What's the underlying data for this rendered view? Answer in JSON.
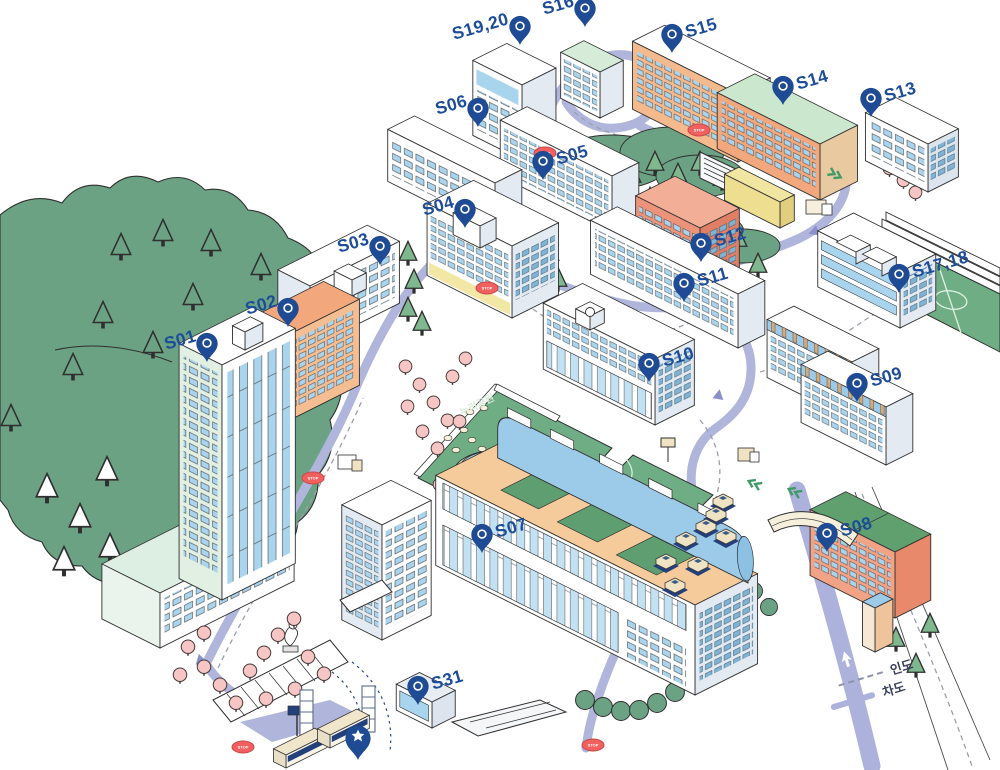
{
  "map": {
    "park_label": "누리공원",
    "stop_sign_label": "STOP",
    "colors": {
      "marker_navy": "#1D4D99",
      "road_lavender": "#B0B5DC",
      "forest_green": "#6CA284",
      "field_green": "#6FAE85",
      "stop_red": "#F15F5F"
    },
    "markers": [
      {
        "id": "s01",
        "label": "S01",
        "x": 207,
        "y": 362,
        "side": "left"
      },
      {
        "id": "s02",
        "label": "S02",
        "x": 288,
        "y": 327,
        "side": "left"
      },
      {
        "id": "s03",
        "label": "S03",
        "x": 380,
        "y": 265,
        "side": "left"
      },
      {
        "id": "s04",
        "label": "S04",
        "x": 465,
        "y": 228,
        "side": "left"
      },
      {
        "id": "s05",
        "label": "S05",
        "x": 543,
        "y": 180,
        "side": "right"
      },
      {
        "id": "s06",
        "label": "S06",
        "x": 478,
        "y": 127,
        "side": "left"
      },
      {
        "id": "s07",
        "label": "S07",
        "x": 482,
        "y": 553,
        "side": "right"
      },
      {
        "id": "s08",
        "label": "S08",
        "x": 827,
        "y": 552,
        "side": "right"
      },
      {
        "id": "s09",
        "label": "S09",
        "x": 857,
        "y": 402,
        "side": "right"
      },
      {
        "id": "s10",
        "label": "S10",
        "x": 649,
        "y": 382,
        "side": "right"
      },
      {
        "id": "s11",
        "label": "S11",
        "x": 684,
        "y": 302,
        "side": "right"
      },
      {
        "id": "s12",
        "label": "S12",
        "x": 701,
        "y": 262,
        "side": "right"
      },
      {
        "id": "s13",
        "label": "S13",
        "x": 871,
        "y": 117,
        "side": "right"
      },
      {
        "id": "s14",
        "label": "S14",
        "x": 783,
        "y": 105,
        "side": "right"
      },
      {
        "id": "s15",
        "label": "S15",
        "x": 672,
        "y": 53,
        "side": "right"
      },
      {
        "id": "s16",
        "label": "S16",
        "x": 585,
        "y": 27,
        "side": "left"
      },
      {
        "id": "s17-18",
        "label": "S17,18",
        "x": 899,
        "y": 293,
        "side": "right"
      },
      {
        "id": "s19-20",
        "label": "S19,20",
        "x": 520,
        "y": 45,
        "side": "left"
      },
      {
        "id": "s31",
        "label": "S31",
        "x": 418,
        "y": 705,
        "side": "right"
      },
      {
        "id": "start",
        "label": "",
        "x": 358,
        "y": 760,
        "side": "right",
        "type": "star"
      }
    ]
  },
  "legend": {
    "items": [
      {
        "label": "인도",
        "style": "dashed"
      },
      {
        "label": "차도",
        "style": "solid"
      }
    ]
  }
}
